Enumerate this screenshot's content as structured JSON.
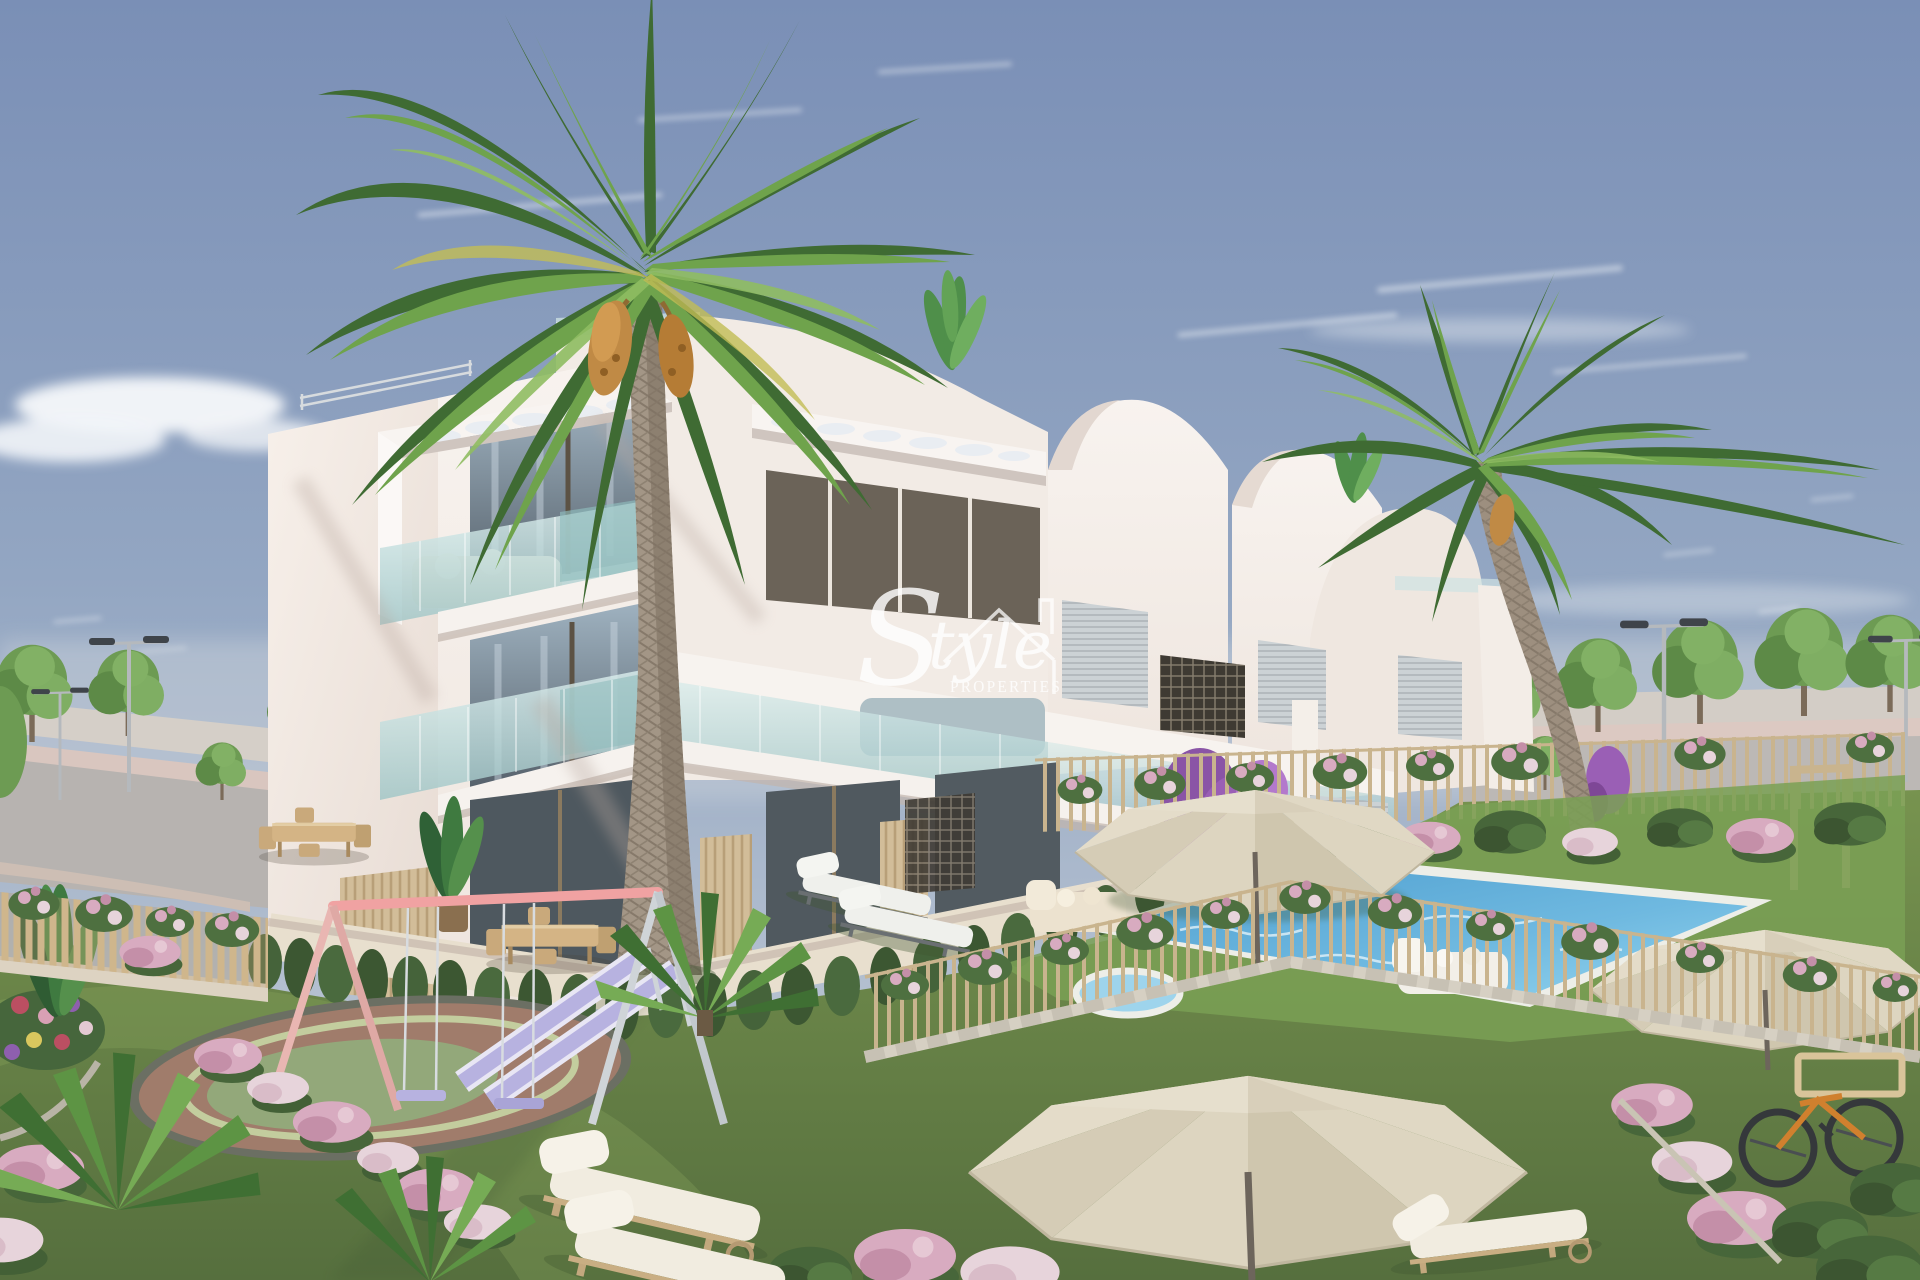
{
  "image": {
    "kind": "architectural-render",
    "subject": "Modern white three-storey apartment complex with communal garden, swimming pool, playground and palm trees under a blue sky",
    "width_px": 1920,
    "height_px": 1280
  },
  "watermark": {
    "brand_initial": "S",
    "brand_rest": "tyle",
    "brand_sub": "PROPERTIES",
    "color": "#ffffff"
  },
  "palette": {
    "sky_top": "#7a8fb6",
    "sky_horizon": "#ccd3dd",
    "cloud": "#f6f8fa",
    "building_white": "#f6f0ea",
    "building_shade": "#e2d7d0",
    "glass_teal": "#bcdcda",
    "window_dark": "#55606a",
    "wood_slat": "#d2bd99",
    "lawn_green": "#6c8a4a",
    "hedge_green": "#45633a",
    "pool_water": "#5fa8d6",
    "fence_beige": "#c9b48e",
    "parasol_cream": "#ddd5c0",
    "playground_pink": "#f0a2a2",
    "slide_lilac": "#b7b2e0",
    "flower_pink": "#d8abc0",
    "bougainvillea": "#9a5fb5",
    "palm_green": "#57893f",
    "palm_trunk": "#9d8f7f",
    "bike_orange": "#d0802e",
    "road_asphalt": "#b7b3b0"
  },
  "scene": {
    "objects": [
      "sky",
      "clouds",
      "street-trees",
      "street-lamps",
      "road",
      "apartment-building",
      "glass-balconies",
      "perforated-canopies",
      "roof-railings",
      "roof-plants",
      "bougainvillea",
      "big-palm-tree",
      "right-palm-tree",
      "garden-lawn",
      "hedge-row",
      "flower-beds",
      "playground-pad",
      "swing-set",
      "double-slide",
      "sun-loungers",
      "dining-tables",
      "outdoor-sofas",
      "swimming-pool",
      "pool-fence",
      "garden-gate",
      "parasols",
      "bicycle",
      "watermark"
    ]
  }
}
